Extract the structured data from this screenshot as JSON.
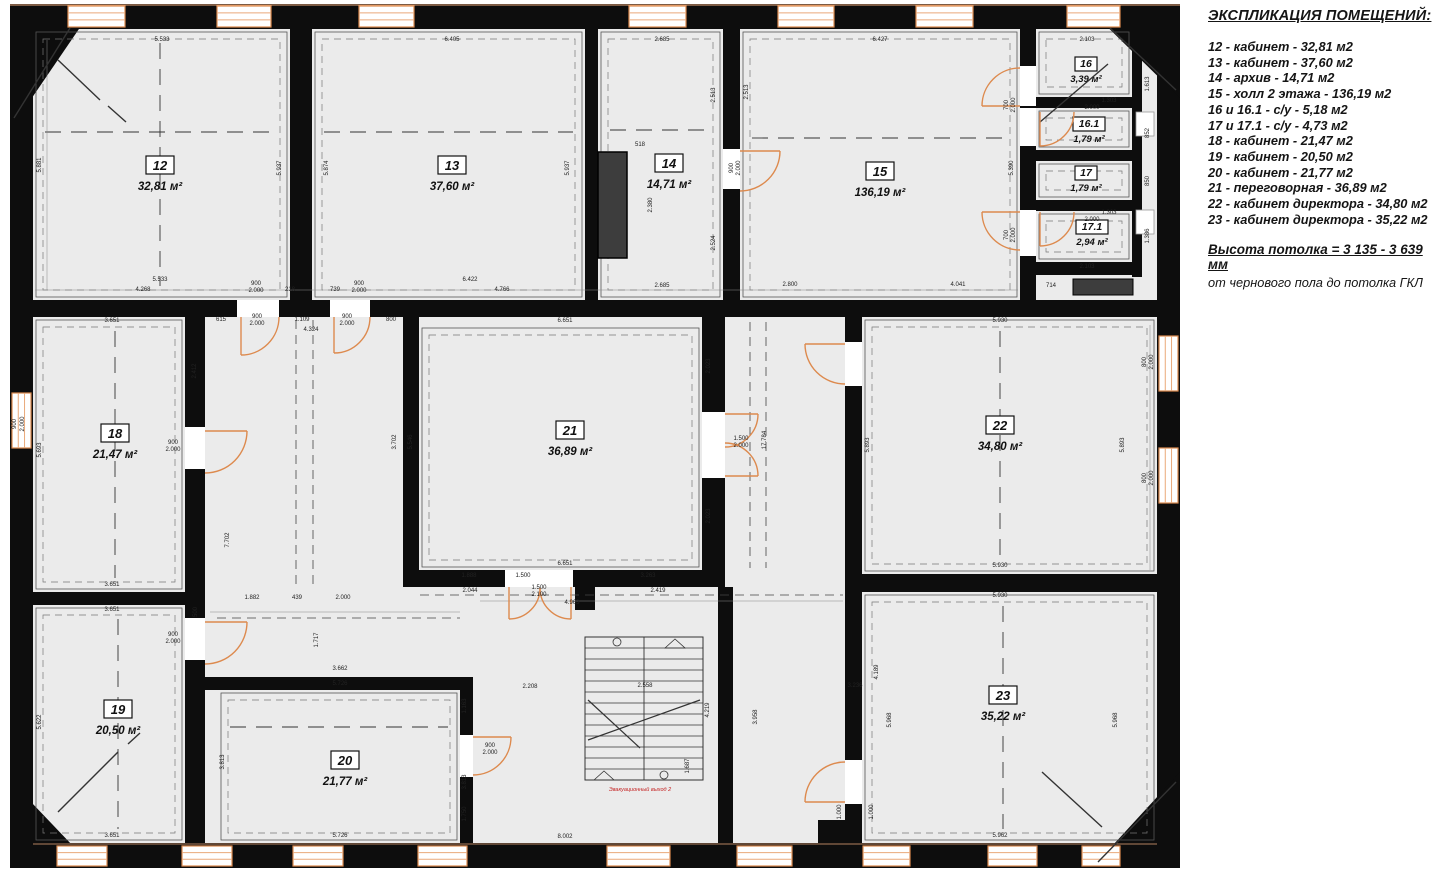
{
  "legend": {
    "title": "ЭКСПЛИКАЦИЯ ПОМЕЩЕНИЙ:",
    "items": [
      "12 - кабинет - 32,81 м2",
      "13 - кабинет - 37,60 м2",
      "14 - архив - 14,71 м2",
      "15 - холл  2 этажа - 136,19 м2",
      "16 и 16.1 - с/у - 5,18 м2",
      "17 и 17.1 - с/у - 4,73 м2",
      "18 - кабинет - 21,47 м2",
      "19 - кабинет - 20,50 м2",
      "20 - кабинет - 21,77 м2",
      "21 - переговорная - 36,89 м2",
      "22 - кабинет директора - 34,80 м2",
      "23 - кабинет директора - 35,22 м2"
    ],
    "note_bold": "Высота потолка = 3 135 - 3 639 мм",
    "note": "от чернового пола до потолка ГКЛ"
  },
  "plan": {
    "colors": {
      "wall": "#0d0d0d",
      "floor": "#ebebeb",
      "window_frame": "#dd8a4e",
      "window_glass": "#ffffff",
      "door_arc": "#dd8a4e",
      "shaft": "#3d3d3d",
      "dimension_text": "#222222",
      "exit_text": "#c42020"
    },
    "rooms": [
      {
        "num": "12",
        "area": "32,81 м²",
        "box": [
          33,
          29,
          257,
          271
        ],
        "label": [
          160,
          170
        ],
        "ax": "hv"
      },
      {
        "num": "13",
        "area": "37,60 м²",
        "box": [
          312,
          29,
          273,
          271
        ],
        "label": [
          452,
          170
        ],
        "ax": "h"
      },
      {
        "num": "14",
        "area": "14,71 м²",
        "box": [
          598,
          29,
          125,
          271
        ],
        "label": [
          669,
          168
        ],
        "ax": "h"
      },
      {
        "num": "15",
        "area": "136,19 м²",
        "box": [
          740,
          29,
          280,
          271
        ],
        "label": [
          880,
          176
        ],
        "ax": "h"
      },
      {
        "num": "16",
        "area": "3,39 м²",
        "box": [
          1036,
          29,
          96,
          68
        ],
        "label": [
          1086,
          67
        ],
        "small": 1
      },
      {
        "num": "16.1",
        "area": "1,79 м²",
        "box": [
          1036,
          108,
          96,
          42
        ],
        "label": [
          1089,
          127
        ],
        "small": 1
      },
      {
        "num": "17",
        "area": "1,79 м²",
        "box": [
          1036,
          161,
          96,
          39
        ],
        "label": [
          1086,
          176
        ],
        "small": 1
      },
      {
        "num": "17.1",
        "area": "2,94 м²",
        "box": [
          1036,
          211,
          96,
          51
        ],
        "label": [
          1092,
          230
        ],
        "small": 1
      },
      {
        "num": "18",
        "area": "21,47 м²",
        "box": [
          33,
          317,
          152,
          275
        ],
        "label": [
          115,
          438
        ],
        "ax": "v"
      },
      {
        "num": "21",
        "area": "36,89 м²",
        "box": [
          419,
          325,
          283,
          245
        ],
        "label": [
          570,
          435
        ],
        "ax": ""
      },
      {
        "num": "22",
        "area": "34,80 м²",
        "box": [
          862,
          317,
          295,
          257
        ],
        "label": [
          1000,
          430
        ],
        "ax": "v"
      },
      {
        "num": "19",
        "area": "20,50 м²",
        "box": [
          33,
          605,
          152,
          238
        ],
        "label": [
          118,
          714
        ],
        "ax": "v"
      },
      {
        "num": "20",
        "area": "21,77 м²",
        "box": [
          218,
          690,
          242,
          153
        ],
        "label": [
          345,
          765
        ],
        "ax": "h"
      },
      {
        "num": "23",
        "area": "35,22 м²",
        "box": [
          862,
          592,
          295,
          251
        ],
        "label": [
          1003,
          700
        ],
        "ax": "v"
      }
    ],
    "dimensions": [
      [
        "5.533",
        162,
        41
      ],
      [
        "6.405",
        452,
        41
      ],
      [
        "2.685",
        662,
        41
      ],
      [
        "6.427",
        880,
        41
      ],
      [
        "2.103",
        1087,
        41
      ],
      [
        "5.881",
        41,
        165,
        1
      ],
      [
        "5.937",
        281,
        168,
        1
      ],
      [
        "5.874",
        328,
        168,
        1
      ],
      [
        "5.937",
        569,
        168,
        1
      ],
      [
        "2.513",
        748,
        92,
        1
      ],
      [
        "5.390",
        1013,
        168,
        1
      ],
      [
        "518",
        640,
        146
      ],
      [
        "2.380",
        652,
        205,
        1
      ],
      [
        "2.513",
        715,
        95,
        1
      ],
      [
        "2.524",
        715,
        243,
        1
      ],
      [
        "1.613",
        1149,
        84,
        1
      ],
      [
        "852",
        1149,
        133,
        1
      ],
      [
        "850",
        1149,
        181,
        1
      ],
      [
        "1.386",
        1149,
        236,
        1
      ],
      [
        "1.303",
        1109,
        102
      ],
      [
        "2.000",
        1092,
        109
      ],
      [
        "1.303",
        1109,
        214
      ],
      [
        "2.000",
        1092,
        221
      ],
      [
        "2.103",
        1087,
        268
      ],
      [
        "714",
        1051,
        287
      ],
      [
        "5.533",
        160,
        281
      ],
      [
        "4.268",
        143,
        291
      ],
      [
        "900",
        256,
        285
      ],
      [
        "2.000",
        256,
        292
      ],
      [
        "218",
        290,
        291
      ],
      [
        "739",
        335,
        291
      ],
      [
        "900",
        359,
        285
      ],
      [
        "2.000",
        359,
        292
      ],
      [
        "6.422",
        470,
        281
      ],
      [
        "4.766",
        502,
        291
      ],
      [
        "2.685",
        662,
        287
      ],
      [
        "2.800",
        790,
        286
      ],
      [
        "4.041",
        958,
        286
      ],
      [
        "900",
        733,
        168,
        1
      ],
      [
        "2.000",
        740,
        168,
        1
      ],
      [
        "700",
        1008,
        105,
        1
      ],
      [
        "2.000",
        1015,
        105,
        1
      ],
      [
        "700",
        1008,
        235,
        1
      ],
      [
        "2.000",
        1015,
        235,
        1
      ],
      [
        "615",
        221,
        321
      ],
      [
        "900",
        257,
        318
      ],
      [
        "2.000",
        257,
        325
      ],
      [
        "1.109",
        302,
        321
      ],
      [
        "900",
        347,
        318
      ],
      [
        "2.000",
        347,
        325
      ],
      [
        "800",
        391,
        321
      ],
      [
        "4.324",
        311,
        331
      ],
      [
        "3.651",
        112,
        322
      ],
      [
        "2.412",
        196,
        371,
        1
      ],
      [
        "5.693",
        41,
        450,
        1
      ],
      [
        "7.702",
        229,
        540,
        1
      ],
      [
        "3.651",
        112,
        586
      ],
      [
        "900",
        173,
        444
      ],
      [
        "2.000",
        173,
        451
      ],
      [
        "900",
        173,
        636
      ],
      [
        "2.000",
        173,
        643
      ],
      [
        "900",
        16,
        424,
        1
      ],
      [
        "2.000",
        24,
        424,
        1
      ],
      [
        "6.651",
        565,
        322
      ],
      [
        "5.546",
        412,
        442,
        1
      ],
      [
        "3.702",
        396,
        442,
        1
      ],
      [
        "2.023",
        710,
        366,
        1
      ],
      [
        "2.023",
        710,
        516,
        1
      ],
      [
        "17.784",
        766,
        440,
        1
      ],
      [
        "1.500",
        741,
        440
      ],
      [
        "2.000",
        741,
        447
      ],
      [
        "6.651",
        565,
        565
      ],
      [
        "1.888",
        469,
        577
      ],
      [
        "1.500",
        523,
        577
      ],
      [
        "3.263",
        648,
        577
      ],
      [
        "2.044",
        470,
        592
      ],
      [
        "1.500",
        539,
        589
      ],
      [
        "2.100",
        539,
        596
      ],
      [
        "4.963",
        572,
        604
      ],
      [
        "2.419",
        658,
        592
      ],
      [
        "1.882",
        252,
        599
      ],
      [
        "439",
        297,
        599
      ],
      [
        "2.000",
        343,
        599
      ],
      [
        "5.930",
        1000,
        322
      ],
      [
        "5.893",
        869,
        445,
        1
      ],
      [
        "5.893",
        1124,
        445,
        1
      ],
      [
        "5.930",
        1000,
        567
      ],
      [
        "800",
        1146,
        362,
        1
      ],
      [
        "2.000",
        1153,
        362,
        1
      ],
      [
        "800",
        1146,
        478,
        1
      ],
      [
        "2.000",
        1153,
        478,
        1
      ],
      [
        "3.651",
        112,
        611
      ],
      [
        "5.622",
        41,
        722,
        1
      ],
      [
        "3.651",
        112,
        837
      ],
      [
        "500",
        197,
        612,
        1
      ],
      [
        "1.717",
        318,
        640,
        1
      ],
      [
        "3.662",
        340,
        670
      ],
      [
        "5.726",
        340,
        685
      ],
      [
        "1.163",
        466,
        706,
        1
      ],
      [
        "3.813",
        224,
        762,
        1
      ],
      [
        "3.813",
        466,
        782,
        1
      ],
      [
        "1.750",
        466,
        814,
        1
      ],
      [
        "5.726",
        340,
        837
      ],
      [
        "900",
        490,
        747
      ],
      [
        "2.000",
        490,
        754
      ],
      [
        "2.208",
        530,
        688
      ],
      [
        "2.558",
        645,
        687
      ],
      [
        "3.236",
        855,
        687
      ],
      [
        "4.219",
        709,
        710,
        1
      ],
      [
        "3.958",
        757,
        717,
        1
      ],
      [
        "1.687",
        689,
        766,
        1
      ],
      [
        "8.002",
        565,
        838
      ],
      [
        "5.930",
        1000,
        597
      ],
      [
        "4.189",
        878,
        672,
        1
      ],
      [
        "5.968",
        891,
        720,
        1
      ],
      [
        "5.968",
        1117,
        720,
        1
      ],
      [
        "1.000",
        841,
        812,
        1
      ],
      [
        "1.000",
        873,
        812,
        1
      ],
      [
        "5.962",
        1000,
        837
      ],
      [
        "Эвакуационный выход 2",
        640,
        791,
        0,
        "red"
      ]
    ]
  }
}
